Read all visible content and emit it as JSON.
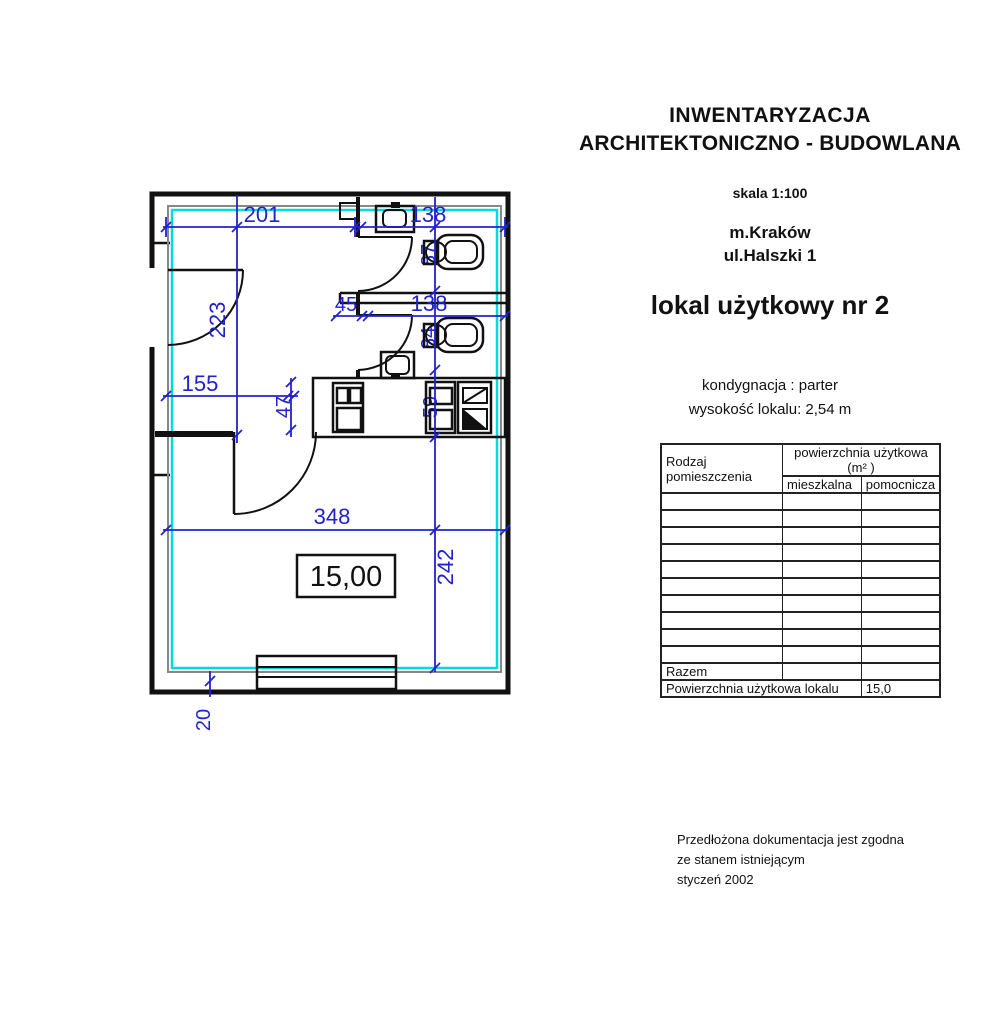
{
  "title_block": {
    "line1": "INWENTARYZACJA",
    "line2": "ARCHITEKTONICZNO - BUDOWLANA",
    "scale": "skala 1:100",
    "city": "m.Kraków",
    "street": "ul.Halszki 1",
    "unit": "lokal użytkowy nr 2",
    "storey": "kondygnacja : parter",
    "unit_height": "wysokość lokalu: 2,54 m"
  },
  "table": {
    "col1_header_line1": "Rodzaj",
    "col1_header_line2": "pomieszczenia",
    "col2_header": "powierzchnia użytkowa (m² )",
    "sub_col_left": "mieszkalna",
    "sub_col_right": "pomocnicza",
    "empty_rows": 10,
    "razem_label": "Razem",
    "total_label": "Powierzchnia użytkowa lokalu",
    "total_value": "15,0"
  },
  "footer": {
    "line1": "Przedłożona dokumentacja jest zgodna",
    "line2": "ze stanem istniejącym",
    "line3": "styczeń 2002"
  },
  "plan": {
    "area_label": "15,00",
    "dims": {
      "top_left": "201",
      "top_right": "138",
      "hall_height": "223",
      "mid_small": "45",
      "mid_right": "138",
      "wc1_depth": "87",
      "wc2_depth": "84",
      "kitchen_depth": "59",
      "hall_width": "155",
      "passage": "47",
      "room_width": "348",
      "room_height": "242",
      "wall_thickness": "20"
    },
    "colors": {
      "dimension_blue": "#2222cc",
      "floor_outline_cyan": "#00dcdc",
      "highlight_yellow": "#f2ea00",
      "wall_black": "#111111"
    }
  }
}
